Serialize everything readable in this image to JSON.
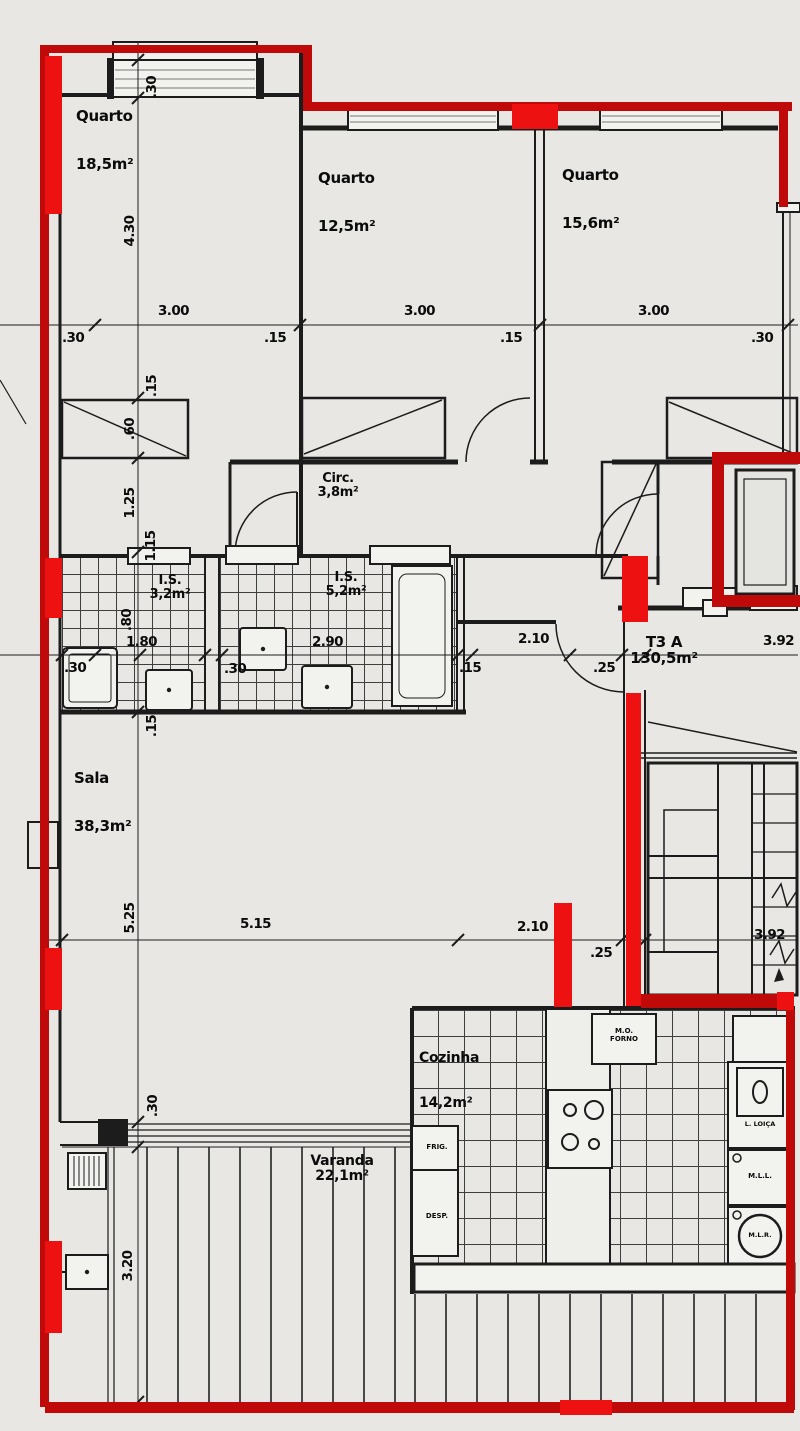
{
  "unit": {
    "code": "T3 A",
    "area": "130,5m²"
  },
  "rooms": {
    "quarto1": {
      "name": "Quarto",
      "area": "18,5m²"
    },
    "quarto2": {
      "name": "Quarto",
      "area": "12,5m²"
    },
    "quarto3": {
      "name": "Quarto",
      "area": "15,6m²"
    },
    "circ": {
      "name": "Circ.",
      "area": "3,8m²"
    },
    "is1": {
      "name": "I.S.",
      "area": "3,2m²"
    },
    "is2": {
      "name": "I.S.",
      "area": "5,2m²"
    },
    "sala": {
      "name": "Sala",
      "area": "38,3m²"
    },
    "cozinha": {
      "name": "Cozinha",
      "area": "14,2m²"
    },
    "varanda": {
      "name": "Varanda",
      "area": "22,1m²"
    }
  },
  "appliances": {
    "mo": "M.O.",
    "forno": "FORNO",
    "frig": "FRIG.",
    "desp": "DESP.",
    "lloica": "L. LOIÇA",
    "mll": "M.L.L.",
    "mlr": "M.L.R."
  },
  "dims": {
    "top": {
      "t1": ".30",
      "t2": "3.00",
      "t3": ".15",
      "t4": "3.00",
      "t5": ".15",
      "t6": "3.00",
      "t7": ".30"
    },
    "left": {
      "l1": ".30",
      "l2": "4.30",
      "l3": ".15",
      "l4": ".60",
      "l5": "1.25",
      "l6": "1.15",
      "l7": ".80",
      "l8": ".15",
      "l9": "5.25",
      "l10": ".30",
      "l11": "3.20"
    },
    "mid": {
      "m1": ".30",
      "m2": "1.80",
      "m3": ".30",
      "m4": "2.90",
      "m5": ".15",
      "m6": "2.10",
      "m7": ".25",
      "m8": "3.92"
    },
    "sala": {
      "s1": "5.15",
      "s2": "2.10",
      "s3": ".25",
      "s4": "3.92"
    }
  },
  "colors": {
    "outline": "#c00a0a",
    "wallred": "#ee1111",
    "ink": "#1c1c1c",
    "bg": "#e8e7e4"
  }
}
